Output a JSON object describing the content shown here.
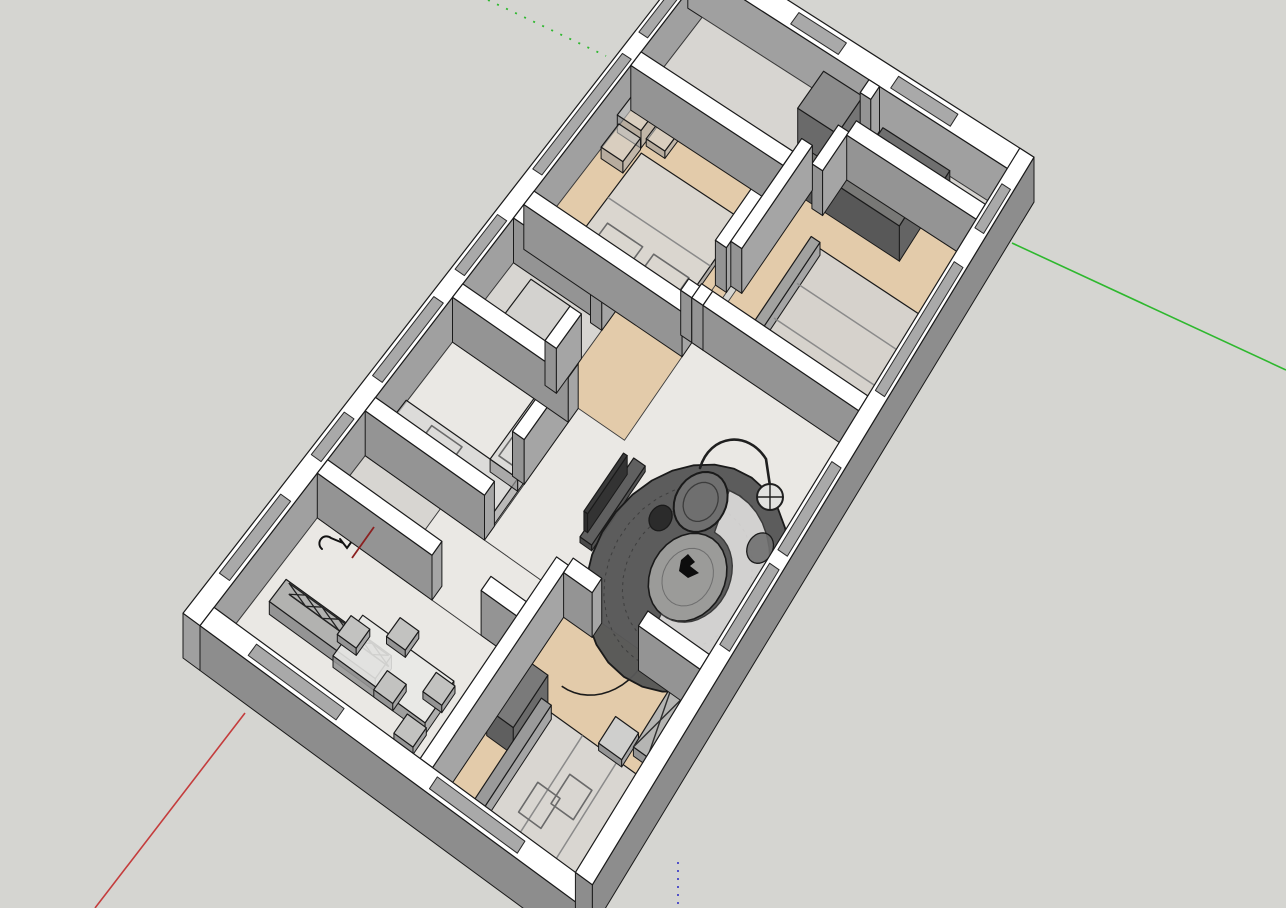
{
  "app": {
    "name": "3d-modeler-viewport",
    "description": "SketchUp-style 3D cutaway floor plan of an apartment, axonometric top view"
  },
  "canvas": {
    "w": 1286,
    "h": 908,
    "bg": "#d5d5d1"
  },
  "colors": {
    "outline": "#1a1a1a",
    "wallTop": "#ffffff",
    "faceL": "#949494",
    "faceR": "#a5a5a5",
    "extInner": "#a0a0a0",
    "extOuter": "#8d8d8d",
    "wood": "#e3cbaa",
    "marble": "#eae8e4",
    "tile": "#d7d5d1",
    "glass": "#a9a9a9",
    "rug": "#575757",
    "rugInner": "#9b9b99",
    "axisGreen": "#2eb82e",
    "axisRed": "#c43c3c",
    "axisRedDark": "#8b2020",
    "axisBlue": "#4343c8"
  },
  "axes": [
    {
      "name": "axis-green-solid",
      "pts": [
        [
          1012,
          243
        ],
        [
          1286,
          370
        ]
      ],
      "color": "axisGreen",
      "dash": null,
      "w": 1.6
    },
    {
      "name": "axis-green-dashed",
      "pts": [
        [
          488,
          0
        ],
        [
          606,
          56
        ]
      ],
      "color": "axisGreen",
      "dash": "2 8",
      "w": 1.8
    },
    {
      "name": "axis-red-solid",
      "pts": [
        [
          245,
          713
        ],
        [
          95,
          908
        ]
      ],
      "color": "axisRed",
      "dash": null,
      "w": 1.6
    },
    {
      "name": "axis-red-dashed",
      "pts": [
        [
          737,
          9
        ],
        [
          720,
          0
        ]
      ],
      "color": "axisRed",
      "dash": "2 6",
      "w": 1.8
    },
    {
      "name": "axis-blue-dashed",
      "pts": [
        [
          678,
          862
        ],
        [
          678,
          908
        ]
      ],
      "color": "axisBlue",
      "dash": "2 6",
      "w": 1.8
    },
    {
      "name": "axis-red-interior",
      "pts": [
        [
          374,
          527
        ],
        [
          352,
          558
        ]
      ],
      "color": "axisRedDark",
      "dash": null,
      "w": 1.8,
      "overlay": true
    }
  ],
  "plan": {
    "w": 1100,
    "h": 700,
    "wallH": 280,
    "map": {
      "x": [
        183,
        519,
        397,
        -65
      ],
      "y": [
        658,
        -668,
        292,
        -80
      ],
      "zlift": 0.16
    }
  },
  "exterior": [
    {
      "name": "ext-wall-upper-left",
      "rect": [
        0,
        0,
        1100,
        30
      ],
      "pass": "far"
    },
    {
      "name": "ext-wall-upper-right",
      "rect": [
        1070,
        0,
        1100,
        700
      ],
      "pass": "far"
    },
    {
      "name": "ext-wall-lower-left",
      "rect": [
        0,
        30,
        30,
        700
      ],
      "pass": "near"
    },
    {
      "name": "ext-wall-lower-right",
      "rect": [
        30,
        670,
        1100,
        700
      ],
      "pass": "near"
    }
  ],
  "windows": {
    "far": [
      [
        70,
        6,
        200,
        24
      ],
      [
        265,
        6,
        335,
        24
      ],
      [
        395,
        6,
        525,
        24
      ],
      [
        570,
        6,
        660,
        24
      ],
      [
        735,
        6,
        925,
        24
      ],
      [
        960,
        6,
        1050,
        24
      ],
      [
        1076,
        210,
        1094,
        310
      ],
      [
        1076,
        420,
        1094,
        545
      ]
    ],
    "near": [
      [
        370,
        676,
        490,
        694
      ],
      [
        510,
        676,
        640,
        694
      ],
      [
        745,
        676,
        935,
        694
      ],
      [
        985,
        676,
        1050,
        694
      ],
      [
        6,
        110,
        24,
        265
      ],
      [
        6,
        430,
        24,
        585
      ]
    ]
  },
  "floors": [
    {
      "name": "floor-dining",
      "rect": [
        30,
        30,
        250,
        395
      ],
      "fill": "marble"
    },
    {
      "name": "floor-utility",
      "rect": [
        250,
        30,
        352,
        170
      ],
      "fill": "tile"
    },
    {
      "name": "floor-corridor-left",
      "rect": [
        250,
        170,
        352,
        395
      ],
      "fill": "marble"
    },
    {
      "name": "floor-kitchen",
      "rect": [
        352,
        30,
        538,
        252
      ],
      "fill": "marble"
    },
    {
      "name": "floor-bathroom-1",
      "rect": [
        538,
        30,
        690,
        210
      ],
      "fill": "tile"
    },
    {
      "name": "floor-living",
      "rect": [
        352,
        252,
        712,
        670
      ],
      "fill": "marble"
    },
    {
      "name": "floor-hallway",
      "rect": [
        560,
        210,
        940,
        341
      ],
      "fill": "wood"
    },
    {
      "name": "floor-bedroom-top",
      "rect": [
        712,
        30,
        940,
        319
      ],
      "fill": "wood"
    },
    {
      "name": "floor-entry",
      "rect": [
        940,
        30,
        1070,
        391
      ],
      "fill": "tile"
    },
    {
      "name": "floor-bedroom-right",
      "rect": [
        723,
        352,
        995,
        670
      ],
      "fill": "wood"
    },
    {
      "name": "floor-bathroom-2",
      "rect": [
        995,
        402,
        1070,
        670
      ],
      "fill": "tile"
    },
    {
      "name": "floor-bedroom-bottom",
      "rect": [
        30,
        417,
        352,
        670
      ],
      "fill": "wood"
    }
  ],
  "walls": [
    {
      "name": "wall-dining-corridor-a",
      "rect": [
        250,
        30,
        272,
        240
      ]
    },
    {
      "name": "wall-dining-corridor-b",
      "rect": [
        250,
        330,
        272,
        395
      ]
    },
    {
      "name": "wall-kitchen-left",
      "rect": [
        352,
        30,
        374,
        252
      ]
    },
    {
      "name": "wall-kitchen-front",
      "rect": [
        440,
        230,
        538,
        252
      ]
    },
    {
      "name": "wall-kitchen-bathroom",
      "rect": [
        538,
        30,
        560,
        252
      ]
    },
    {
      "name": "wall-bathroom1-right",
      "rect": [
        668,
        30,
        690,
        210
      ]
    },
    {
      "name": "wall-bathroom1-front-a",
      "rect": [
        560,
        188,
        615,
        210
      ]
    },
    {
      "name": "wall-bathroom1-front-b",
      "rect": [
        660,
        188,
        690,
        210
      ]
    },
    {
      "name": "wall-bedroom-top-left",
      "rect": [
        690,
        30,
        712,
        341
      ]
    },
    {
      "name": "wall-bedroom-top-front-a",
      "rect": [
        712,
        319,
        730,
        341
      ]
    },
    {
      "name": "wall-bedroom-top-front-b",
      "rect": [
        790,
        319,
        940,
        341
      ]
    },
    {
      "name": "wall-bedroom-top-right",
      "rect": [
        918,
        30,
        940,
        341
      ]
    },
    {
      "name": "wall-entry-bath2-a",
      "rect": [
        940,
        380,
        1000,
        402
      ]
    },
    {
      "name": "wall-entry-bath2-b",
      "rect": [
        1050,
        380,
        1070,
        402
      ]
    },
    {
      "name": "wall-bedroom-right-top-a",
      "rect": [
        712,
        341,
        734,
        363
      ]
    },
    {
      "name": "wall-bedroom-right-top-b",
      "rect": [
        800,
        341,
        960,
        363
      ]
    },
    {
      "name": "wall-bedroom-right-left",
      "rect": [
        712,
        363,
        734,
        670
      ]
    },
    {
      "name": "wall-bath2-left",
      "rect": [
        995,
        402,
        1017,
        670
      ]
    },
    {
      "name": "wall-dining-bedroom",
      "rect": [
        30,
        395,
        341,
        417
      ]
    },
    {
      "name": "wall-bedroom-bottom-a",
      "rect": [
        330,
        417,
        352,
        470
      ]
    },
    {
      "name": "wall-bedroom-bottom-b",
      "rect": [
        330,
        556,
        352,
        670
      ]
    }
  ],
  "furniture": [
    {
      "name": "dining-sideboard",
      "type": "prism",
      "rect": [
        112,
        60,
        148,
        250
      ],
      "z": 80,
      "top": "#b2b2b0"
    },
    {
      "name": "dining-sideboard-truss",
      "type": "lattice",
      "u": 148,
      "v0": 65,
      "v1": 245,
      "z": 70,
      "n": 6
    },
    {
      "name": "dining-table",
      "type": "prism",
      "rect": [
        105,
        180,
        170,
        345
      ],
      "z": 72,
      "top": "#e8e8e6",
      "op": 0.88
    },
    {
      "name": "dining-chair",
      "type": "prism",
      "rect": [
        135,
        163,
        165,
        197
      ],
      "z": 46,
      "top": "#c2c2c0"
    },
    {
      "name": "dining-chair",
      "type": "prism",
      "rect": [
        170,
        223,
        200,
        257
      ],
      "z": 46,
      "top": "#c2c2c0"
    },
    {
      "name": "dining-chair",
      "type": "prism",
      "rect": [
        105,
        253,
        135,
        287
      ],
      "z": 46,
      "top": "#c2c2c0"
    },
    {
      "name": "dining-chair",
      "type": "prism",
      "rect": [
        140,
        313,
        170,
        347
      ],
      "z": 46,
      "top": "#c2c2c0"
    },
    {
      "name": "dining-chair",
      "type": "prism",
      "rect": [
        75,
        313,
        105,
        347
      ],
      "z": 46,
      "top": "#c2c2c0"
    },
    {
      "name": "bedroom-bottom-desk",
      "type": "prism",
      "rect": [
        150,
        420,
        230,
        468
      ],
      "z": 170,
      "top": "#7a7a7a",
      "sideL": "#5f5f5f",
      "sideR": "#6b6b6b"
    },
    {
      "name": "bedroom-bottom-bed",
      "type": "prism",
      "rect": [
        40,
        480,
        215,
        670
      ],
      "z": 40,
      "top": "#d7d7d5",
      "op": 0.9
    },
    {
      "name": "bedroom-bottom-bed-head",
      "type": "prism",
      "rect": [
        40,
        468,
        215,
        486
      ],
      "z": 88,
      "top": "#9a9a9a"
    },
    {
      "name": "bedroom-bottom-bed-seams",
      "type": "lines",
      "segs": [
        [
          40,
          543,
          215,
          543
        ],
        [
          40,
          607,
          215,
          607
        ]
      ],
      "z": 40
    },
    {
      "name": "bedroom-bottom-nightstand",
      "type": "prism",
      "rect": [
        218,
        570,
        258,
        612
      ],
      "z": 46,
      "top": "#cfcfcd"
    },
    {
      "name": "bedroom-bottom-wardrobe",
      "type": "prism",
      "rect": [
        238,
        618,
        332,
        670
      ],
      "z": 56,
      "top": "#b5b5b3"
    },
    {
      "name": "bedroom-bottom-wardrobe-x",
      "type": "xtop",
      "rect": [
        238,
        618,
        332,
        670
      ],
      "z": 56,
      "cells": 2
    },
    {
      "name": "bedroom-bottom-mat",
      "type": "outlineRect",
      "rect": [
        95,
        520,
        140,
        560
      ],
      "z": 0
    },
    {
      "name": "bedroom-bottom-mat",
      "type": "outlineRect",
      "rect": [
        128,
        553,
        172,
        593
      ],
      "z": 0
    },
    {
      "name": "bedroom-bottom-door-swing",
      "type": "doorArc",
      "pivot": [
        341,
        472
      ],
      "r": 84,
      "a0": 180,
      "a1": 90
    },
    {
      "name": "kitchen-counter-left",
      "type": "prism",
      "rect": [
        374,
        40,
        428,
        250
      ],
      "z": 80,
      "top": "#d6d6d4",
      "op": 0.7
    },
    {
      "name": "kitchen-counter-front",
      "type": "prism",
      "rect": [
        428,
        198,
        556,
        250
      ],
      "z": 80,
      "top": "#d6d6d4",
      "op": 0.7
    },
    {
      "name": "kitchen-sink",
      "type": "outlineRect",
      "rect": [
        382,
        95,
        420,
        152
      ],
      "z": 80
    },
    {
      "name": "kitchen-stove",
      "type": "outlineRect",
      "rect": [
        438,
        206,
        546,
        246
      ],
      "z": 80
    },
    {
      "name": "kitchen-burner",
      "type": "burner",
      "c": [
        468,
        226
      ],
      "r": 13,
      "z": 80
    },
    {
      "name": "kitchen-burner",
      "type": "burner",
      "c": [
        510,
        226
      ],
      "r": 13,
      "z": 80
    },
    {
      "name": "bathroom-1-vanity",
      "type": "prism",
      "rect": [
        575,
        85,
        645,
        162
      ],
      "z": 105,
      "top": "#d0d0ce",
      "op": 0.55
    },
    {
      "name": "tv-console",
      "type": "prism",
      "rect": [
        420,
        374,
        542,
        396
      ],
      "z": 36,
      "top": "#606060",
      "sideL": "#4a4a4a",
      "sideR": "#525252"
    },
    {
      "name": "tv-panel",
      "type": "prism",
      "rect": [
        436,
        368,
        526,
        375
      ],
      "z": 118,
      "top": "#3a3a3a",
      "sideL": "#2e2e2e",
      "sideR": "#333333"
    },
    {
      "name": "living-rug",
      "type": "rug",
      "c": [
        462,
        543
      ],
      "r": 150
    },
    {
      "name": "living-sofa",
      "type": "sofa",
      "c": [
        462,
        548
      ],
      "r1": 62,
      "r2": 118,
      "a0": -10,
      "a1": 185,
      "z": 30
    },
    {
      "name": "sofa-cushion",
      "type": "circle",
      "c": [
        540,
        618
      ],
      "r": 20,
      "z": 32,
      "fill": "#6f6f6f",
      "op": 0.9
    },
    {
      "name": "living-armchair",
      "type": "circle",
      "c": [
        545,
        500
      ],
      "r": 40,
      "z": 34,
      "fill": "#6f6f6f",
      "w": 2
    },
    {
      "name": "living-armchair-seat",
      "type": "circle",
      "c": [
        545,
        500
      ],
      "r": 26,
      "z": 34,
      "fill": "none",
      "stroke": "#3c3c3c"
    },
    {
      "name": "living-side-table",
      "type": "circle",
      "c": [
        498,
        462
      ],
      "r": 17,
      "z": 40,
      "fill": "#2b2b2b"
    },
    {
      "name": "living-ottoman",
      "type": "circle",
      "c": [
        362,
        597
      ],
      "r": 30,
      "z": 30,
      "fill": "#d4d4d2"
    },
    {
      "name": "cat-figure",
      "type": "screenPoly",
      "pts": [
        [
          681,
          560
        ],
        [
          688,
          554
        ],
        [
          695,
          562
        ],
        [
          690,
          566
        ],
        [
          699,
          573
        ],
        [
          688,
          578
        ],
        [
          679,
          571
        ]
      ],
      "fill": "#0d0d0d"
    },
    {
      "name": "floor-lamp-arc",
      "type": "screenPath",
      "d": "M 700 468 C 710 434 748 430 766 459 L 770 486",
      "stroke": "#1f1f1f",
      "w": 2.6
    },
    {
      "name": "floor-lamp-shade",
      "type": "screenCircle",
      "c": [
        770,
        497
      ],
      "r": 13,
      "fill": "#e2e2e0",
      "stroke": "#1f1f1f",
      "w": 2,
      "cross": true
    },
    {
      "name": "bedroom-top-bed",
      "type": "prism",
      "rect": [
        712,
        95,
        872,
        300
      ],
      "z": 40,
      "top": "#d8d8d6",
      "op": 0.85
    },
    {
      "name": "bedroom-top-bed-head",
      "type": "prism",
      "rect": [
        712,
        95,
        728,
        300
      ],
      "z": 92,
      "top": "#8f8f8f"
    },
    {
      "name": "bedroom-top-pillow",
      "type": "outlineRect",
      "rect": [
        734,
        120,
        772,
        190
      ],
      "z": 40
    },
    {
      "name": "bedroom-top-pillow",
      "type": "outlineRect",
      "rect": [
        734,
        212,
        772,
        282
      ],
      "z": 40
    },
    {
      "name": "bedroom-top-bed-seams",
      "type": "lines",
      "segs": [
        [
          800,
          95,
          800,
          300
        ]
      ],
      "z": 40
    },
    {
      "name": "bedroom-top-storage-box",
      "type": "prism",
      "rect": [
        884,
        35,
        932,
        83
      ],
      "z": 110,
      "top": "#d2d2d0",
      "op": 0.55
    },
    {
      "name": "bedroom-top-storage-box",
      "type": "prism",
      "rect": [
        844,
        40,
        882,
        84
      ],
      "z": 72,
      "top": "#d2d2d0",
      "op": 0.55
    },
    {
      "name": "bedroom-top-storage-box",
      "type": "prism",
      "rect": [
        890,
        88,
        930,
        126
      ],
      "z": 46,
      "top": "#d2d2d0",
      "op": 0.55
    },
    {
      "name": "bedroom-right-bed",
      "type": "prism",
      "rect": [
        736,
        430,
        896,
        650
      ],
      "z": 40,
      "top": "#d4d4d2",
      "op": 0.85
    },
    {
      "name": "bedroom-right-bed-head",
      "type": "prism",
      "rect": [
        736,
        418,
        896,
        436
      ],
      "z": 80,
      "top": "#a2a2a0"
    },
    {
      "name": "bedroom-right-bed-seams",
      "type": "lines",
      "segs": [
        [
          790,
          436,
          790,
          650
        ],
        [
          843,
          436,
          843,
          650
        ]
      ],
      "z": 40
    },
    {
      "name": "bedroom-right-wardrobe",
      "type": "prism",
      "rect": [
        945,
        360,
        995,
        555
      ],
      "z": 220,
      "top": "#787876",
      "sideL": "#585858",
      "sideR": "#646464"
    },
    {
      "name": "entry-cabinet",
      "type": "prism",
      "rect": [
        1000,
        296,
        1058,
        378
      ],
      "z": 220,
      "top": "#8c8c8c",
      "sideL": "#6a6a6a",
      "sideR": "#757575"
    },
    {
      "name": "bathroom-2-shower",
      "type": "prism",
      "rect": [
        1008,
        420,
        1058,
        560
      ],
      "z": 105,
      "top": "#6f6f6f",
      "sideL": "#545454",
      "sideR": "#606060"
    },
    {
      "name": "utility-faucet",
      "type": "screenPath",
      "d": "M 322 549 a 7 7 0 1 1 9 -11 l 12 5 m -3 -4 l 7 9 l 5 -7",
      "stroke": "#111111",
      "w": 2
    }
  ]
}
